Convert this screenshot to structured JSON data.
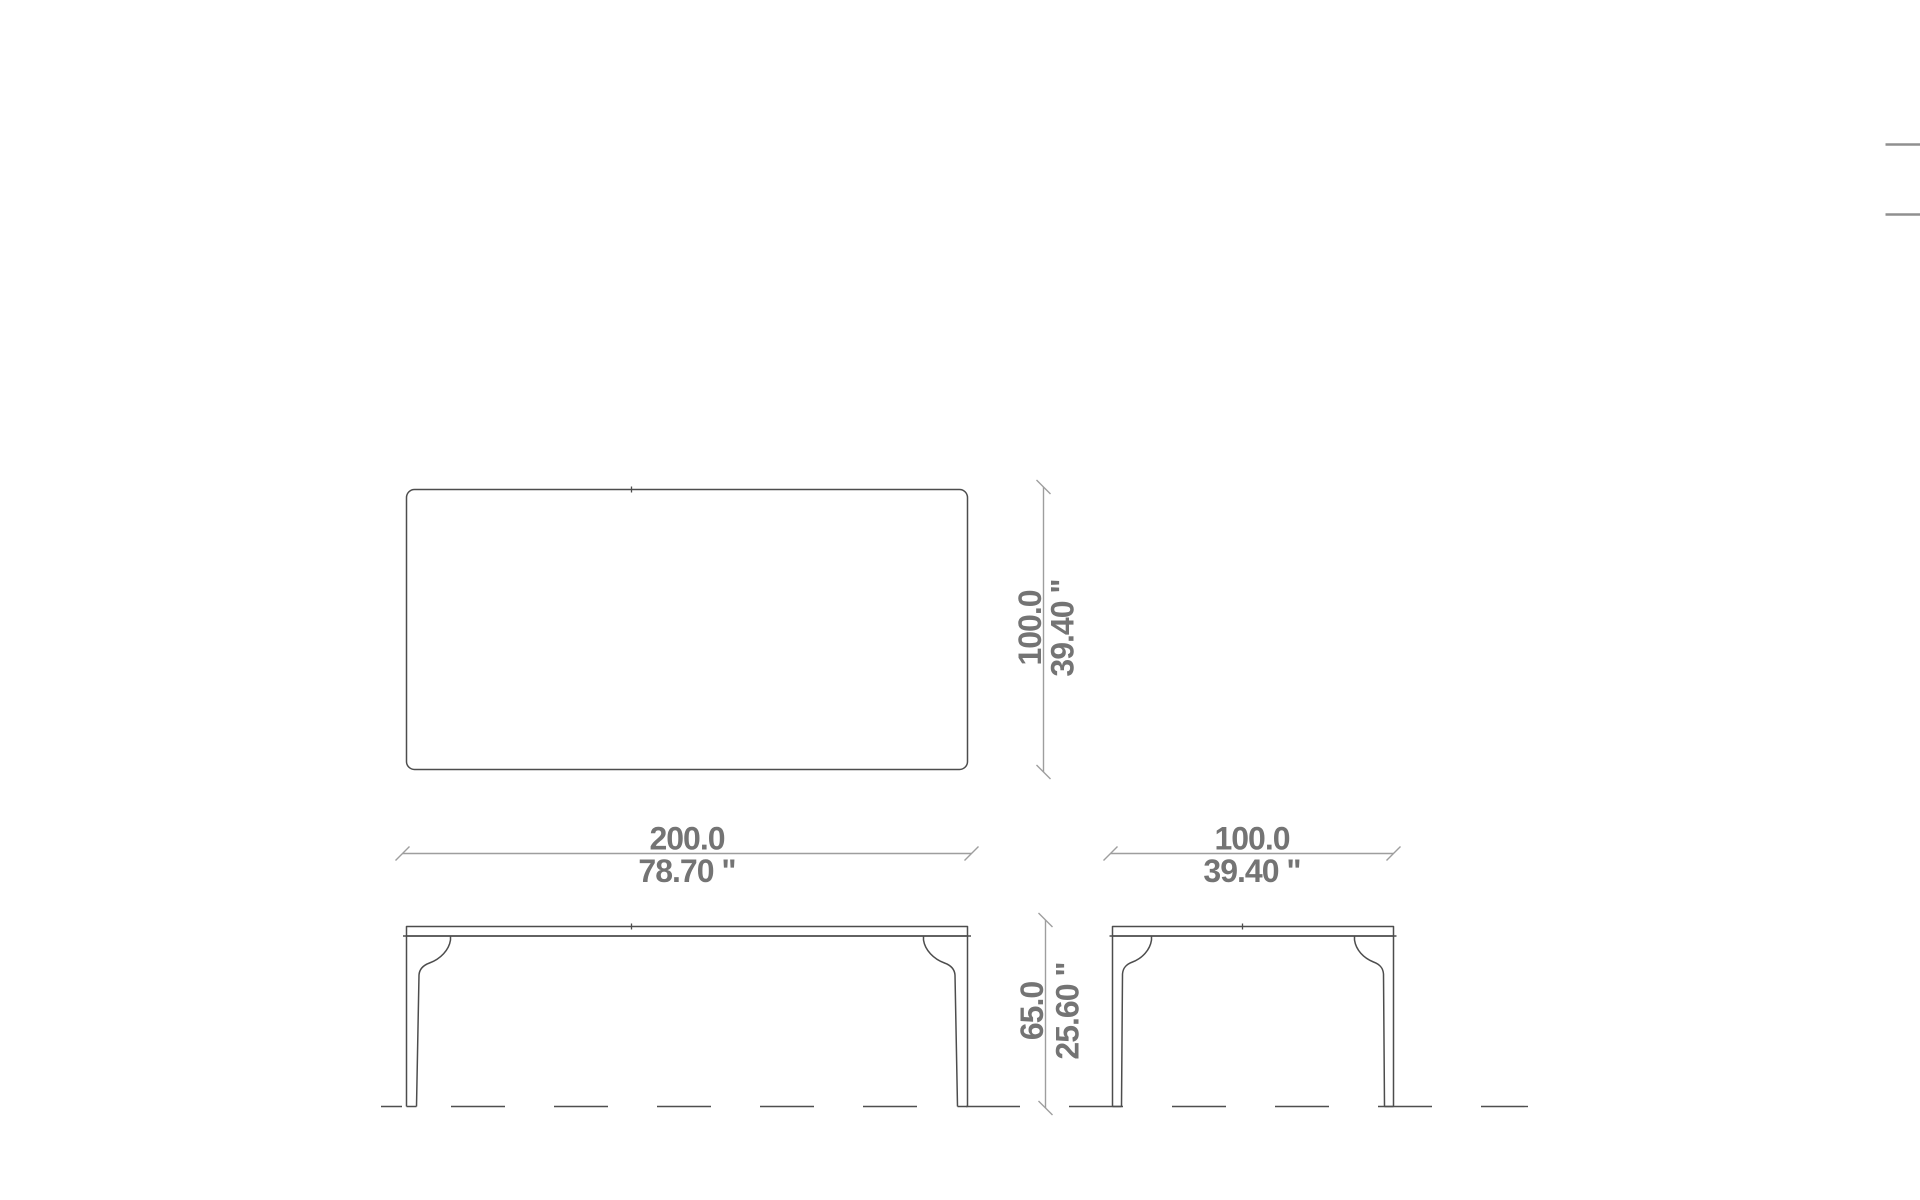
{
  "colors": {
    "drawing_line": "#4d4d4d",
    "dimension_line": "#9e9e9e",
    "dimension_text": "#747474",
    "edge_artifact": "#8f8f8f",
    "background": "#ffffff"
  },
  "dimensions": {
    "plan_width": {
      "metric": "200.0",
      "imperial": "78.70 \""
    },
    "plan_depth": {
      "metric": "100.0",
      "imperial": "39.40 \""
    },
    "side_width": {
      "metric": "100.0",
      "imperial": "39.40 \""
    },
    "height": {
      "metric": "65.0",
      "imperial": "25.60 \""
    }
  }
}
